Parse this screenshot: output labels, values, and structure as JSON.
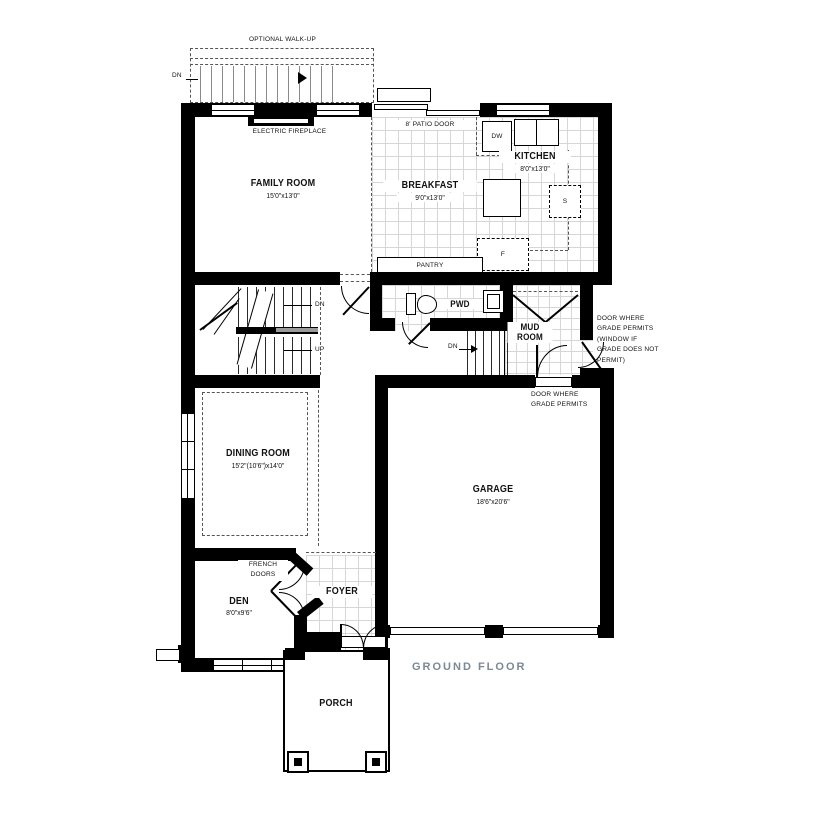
{
  "floor_label": "GROUND FLOOR",
  "rooms": {
    "family": {
      "name": "FAMILY ROOM",
      "dims": "15'0\"x13'0\""
    },
    "breakfast": {
      "name": "BREAKFAST",
      "dims": "9'0\"x13'0\""
    },
    "kitchen": {
      "name": "KITCHEN",
      "dims": "8'0\"x13'0\""
    },
    "dining": {
      "name": "DINING ROOM",
      "dims": "15'2\"(10'6\")x14'0\""
    },
    "garage": {
      "name": "GARAGE",
      "dims": "18'6\"x20'6\""
    },
    "den": {
      "name": "DEN",
      "dims": "8'0\"x9'6\""
    },
    "foyer": {
      "name": "FOYER"
    },
    "porch": {
      "name": "PORCH"
    },
    "pwd": {
      "name": "PWD"
    },
    "mud": {
      "name": "MUD\nROOM"
    },
    "pantry": {
      "name": "PANTRY"
    }
  },
  "annotations": {
    "walkup": "OPTIONAL WALK-UP",
    "walkup_dn": "DN",
    "fireplace": "ELECTRIC FIREPLACE",
    "patio_door": "8' PATIO DOOR",
    "french_doors": "FRENCH\nDOORS",
    "stair_dn": "DN",
    "stair_up": "UP",
    "bsmt_dn": "DN",
    "grade_door_note": "DOOR WHERE\nGRADE PERMITS\n(WINDOW IF\nGRADE DOES NOT\nPERMIT)",
    "grade_door_short": "DOOR WHERE\nGRADE PERMITS"
  },
  "appliances": {
    "dishwasher": "DW",
    "stove": "S",
    "fridge": "F"
  },
  "colors": {
    "wall": "#000000",
    "floor_label_text": "#7c8894",
    "tile_grid": "#d6d6d6"
  }
}
